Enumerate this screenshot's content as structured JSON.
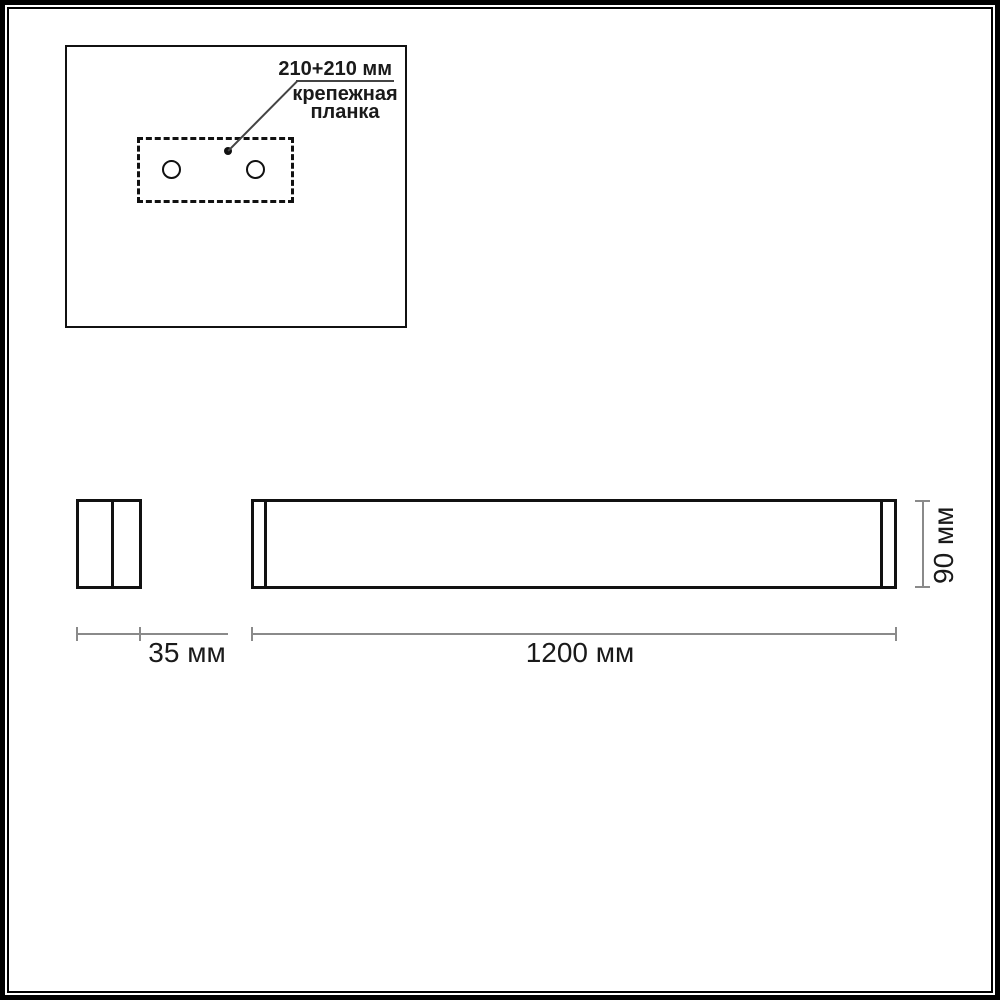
{
  "inset": {
    "dimension_label": "210+210 мм",
    "part_label": "крепежная планка"
  },
  "dimensions": {
    "depth": "35 мм",
    "length": "1200 мм",
    "height": "90 мм"
  },
  "colors": {
    "outline": "#111111",
    "dimension_line": "#8a8a8a",
    "text": "#1a1a1a",
    "frame": "#000000",
    "background": "#ffffff"
  }
}
